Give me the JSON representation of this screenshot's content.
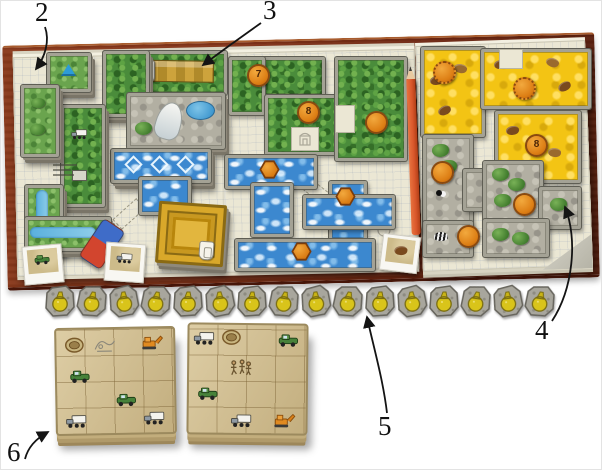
{
  "callouts": {
    "tile_supply": "2",
    "game_board": "3",
    "right_board": "4",
    "money_tokens": "5",
    "player_boards": "6"
  },
  "board_tokens": {
    "jungle_1": "7",
    "jungle_2": "8",
    "jungle_3": "",
    "water_1": "",
    "water_2": "",
    "water_3": "",
    "savanna_1": "",
    "savanna_2": "",
    "savanna_3": "8",
    "rock_1": "",
    "rock_2": "",
    "rock_3": ""
  },
  "money_token_row": {
    "count": 16,
    "icon": "money-pouch-icon"
  },
  "player_board_stacks": {
    "count": 2
  },
  "colors": {
    "wood": "#8a3a1c",
    "paper": "#ebe7d4",
    "jungle": "#4a8c3b",
    "water": "#3c88cf",
    "savanna": "#f3c414",
    "rock": "#b2afa2",
    "kraft": "#cfbc8d",
    "token-orange": "#e0851c",
    "stone-gray": "#a8a69d",
    "pouch-yellow": "#d9c41a",
    "eraser-blue": "#3f6cc8",
    "eraser-red": "#d2452e",
    "pencil-red": "#d9572b"
  }
}
